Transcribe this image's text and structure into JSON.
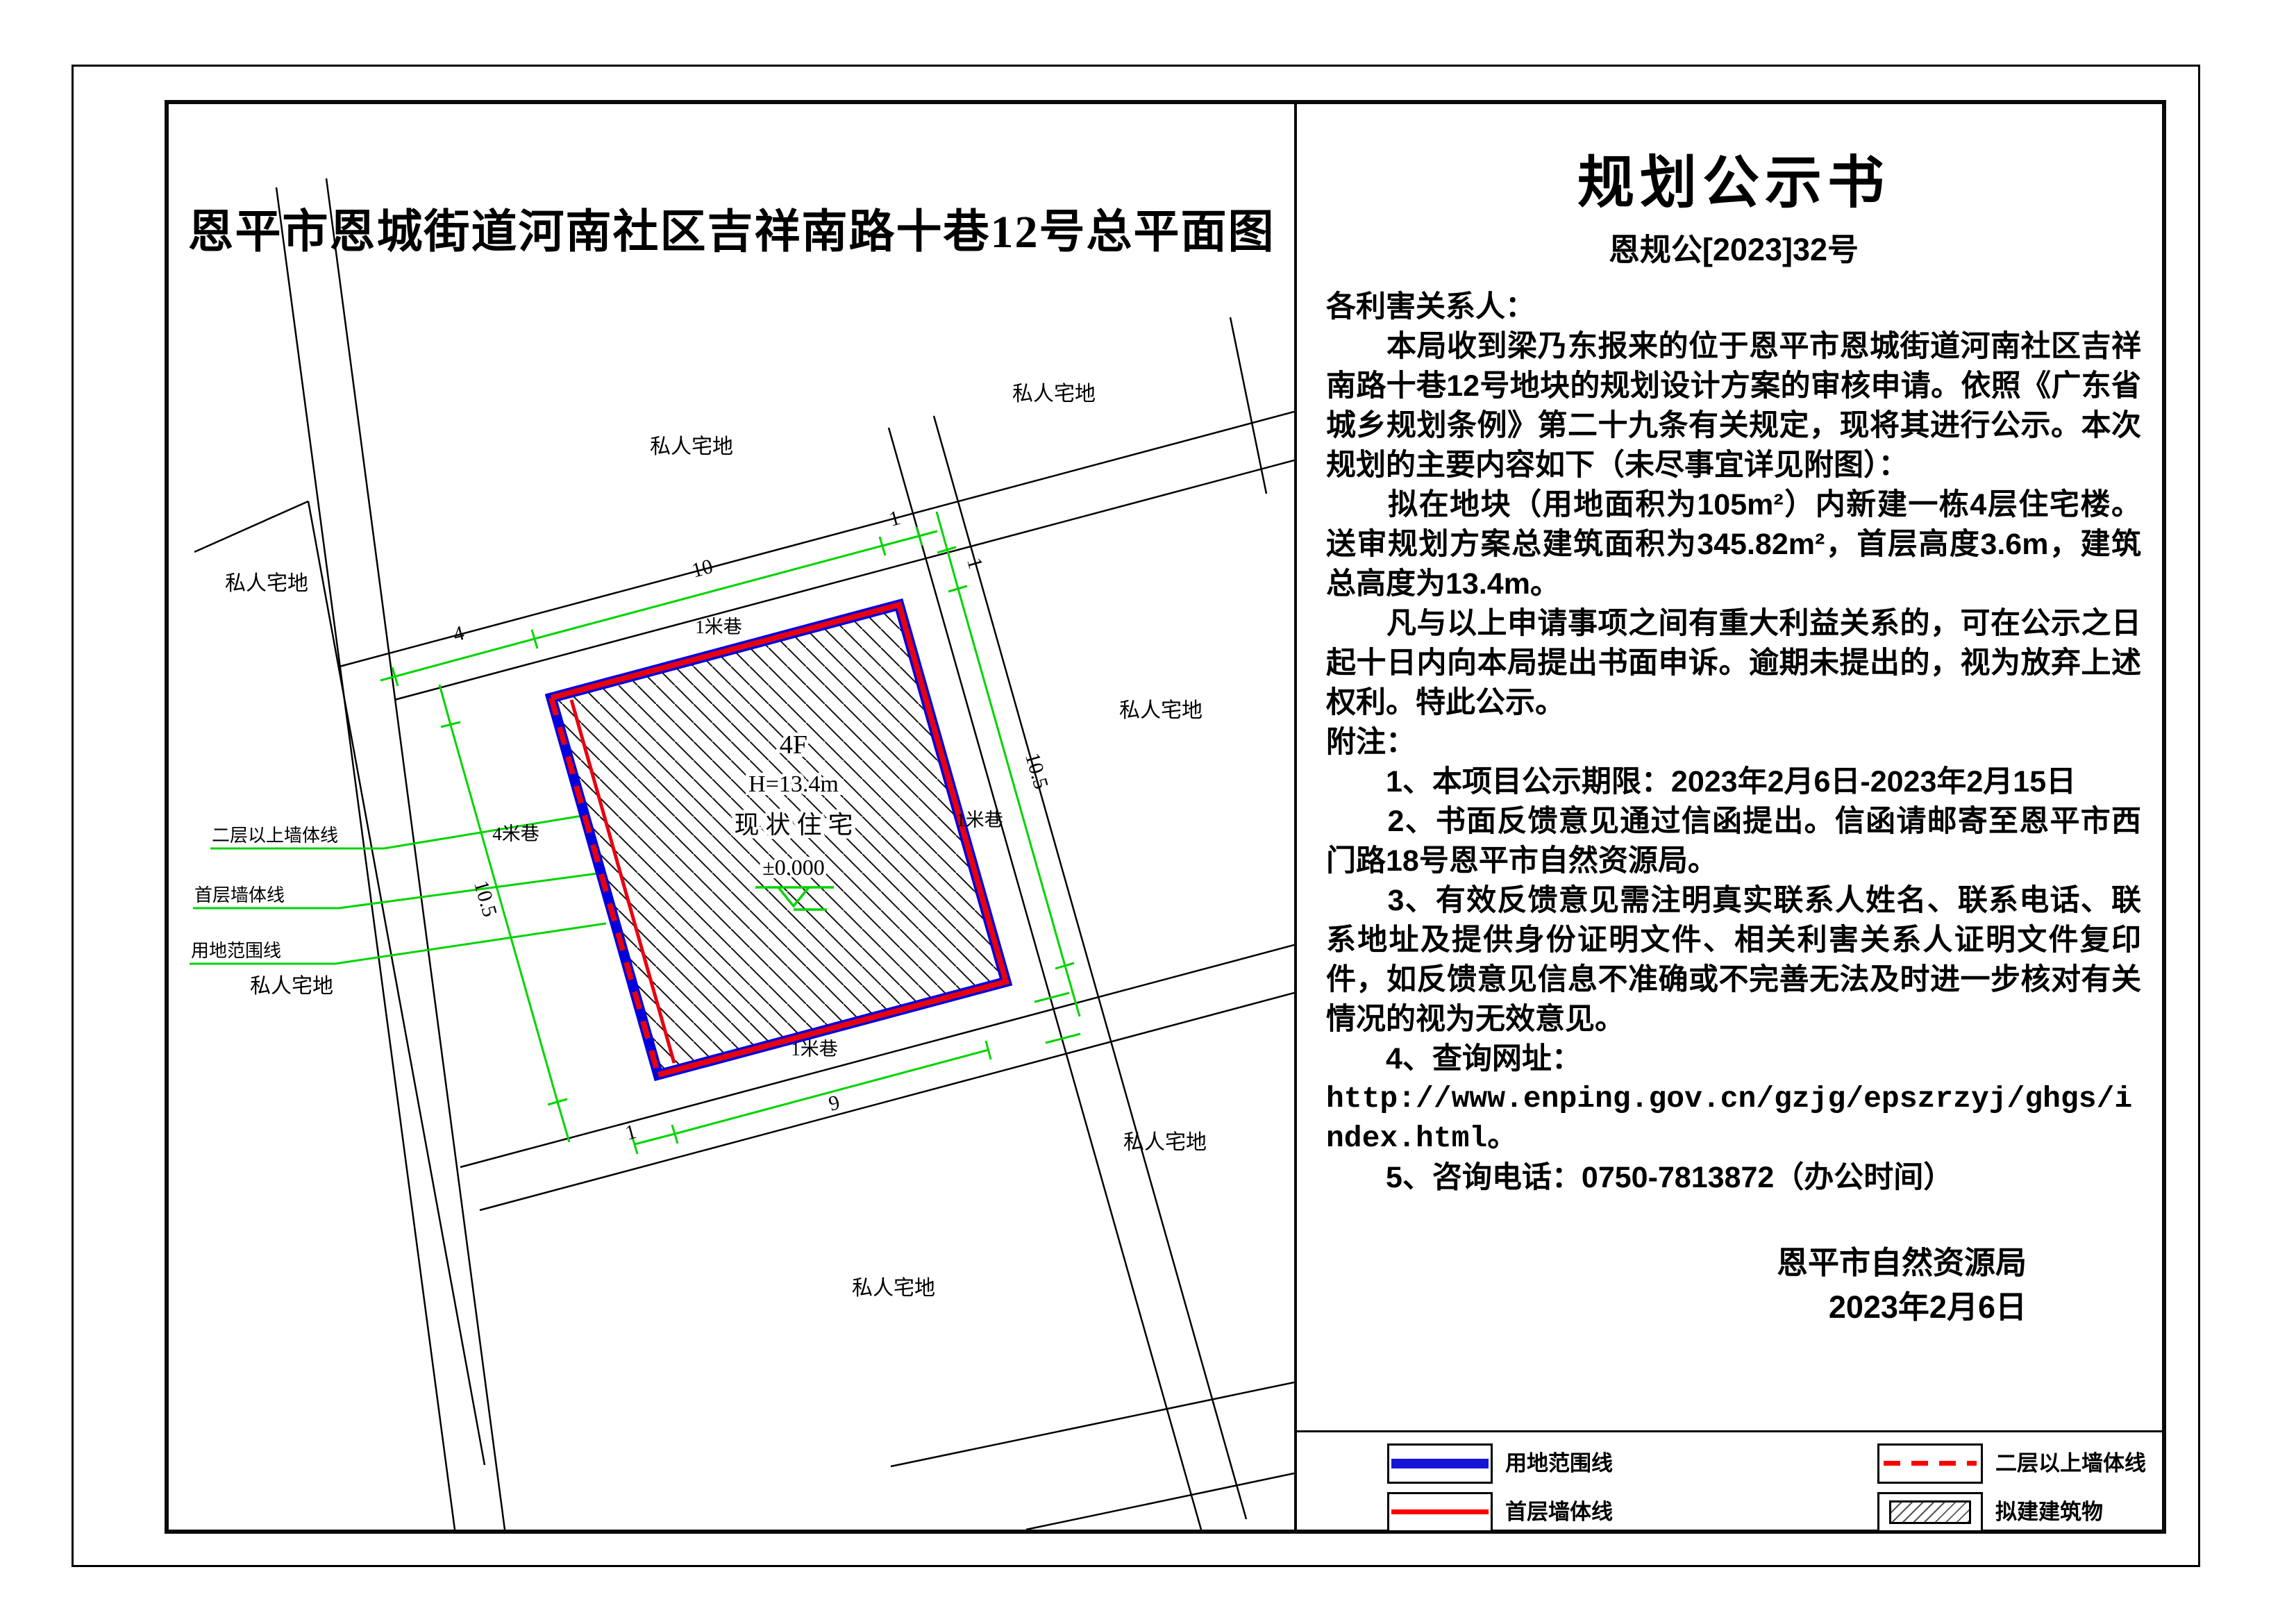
{
  "page": {
    "map_title": "恩平市恩城街道河南社区吉祥南路十巷12号总平面图"
  },
  "notice": {
    "title": "规划公示书",
    "doc_no": "恩规公[2023]32号",
    "salutation": "各利害关系人：",
    "paragraphs": [
      "　　本局收到梁乃东报来的位于恩平市恩城街道河南社区吉祥南路十巷12号地块的规划设计方案的审核申请。依照《广东省城乡规划条例》第二十九条有关规定，现将其进行公示。本次规划的主要内容如下（未尽事宜详见附图）：",
      "　　拟在地块（用地面积为105m²）内新建一栋4层住宅楼。送审规划方案总建筑面积为345.82m²，首层高度3.6m，建筑总高度为13.4m。",
      "　　凡与以上申请事项之间有重大利益关系的，可在公示之日起十日内向本局提出书面申诉。逾期未提出的，视为放弃上述权利。特此公示。",
      "附注：",
      "　　1、本项目公示期限：2023年2月6日-2023年2月15日",
      "　　2、书面反馈意见通过信函提出。信函请邮寄至恩平市西门路18号恩平市自然资源局。",
      "　　3、有效反馈意见需注明真实联系人姓名、联系电话、联系地址及提供身份证明文件、相关利害关系人证明文件复印件，如反馈意见信息不准确或不完善无法及时进一步核对有关情况的视为无效意见。",
      "　　4、查询网址：",
      "http://www.enping.gov.cn/gzjg/epszrzyj/ghgs/index.html。",
      "　　5、咨询电话：0750-7813872（办公时间）"
    ],
    "signature": {
      "agency": "恩平市自然资源局",
      "date": "2023年2月6日"
    }
  },
  "map": {
    "parcel_label": "私人宅地",
    "lane_1m": "1米巷",
    "lane_4m": "4米巷",
    "dims": {
      "ten": "10",
      "ten_five": "10.5",
      "nine": "9",
      "four": "4",
      "one": "1"
    },
    "building": {
      "floors": "4F",
      "height": "H=13.4m",
      "status": "现 状 住 宅",
      "level": "±0.000"
    },
    "leaders": {
      "upper_wall": "二层以上墙体线",
      "first_wall": "首层墙体线",
      "boundary": "用地范围线"
    }
  },
  "legend": {
    "items": [
      {
        "label": "用地范围线",
        "type": "blue-solid"
      },
      {
        "label": "首层墙体线",
        "type": "red-solid"
      },
      {
        "label": "二层以上墙体线",
        "type": "red-dashed"
      },
      {
        "label": "拟建建筑物",
        "type": "hatch"
      }
    ]
  },
  "colors": {
    "dim_green": "#00d400",
    "wall_red": "#e8000f",
    "boundary_blue": "#0000dd",
    "legend_blue": "#1515d8",
    "legend_red": "#ff0000",
    "line_black": "#000000"
  }
}
